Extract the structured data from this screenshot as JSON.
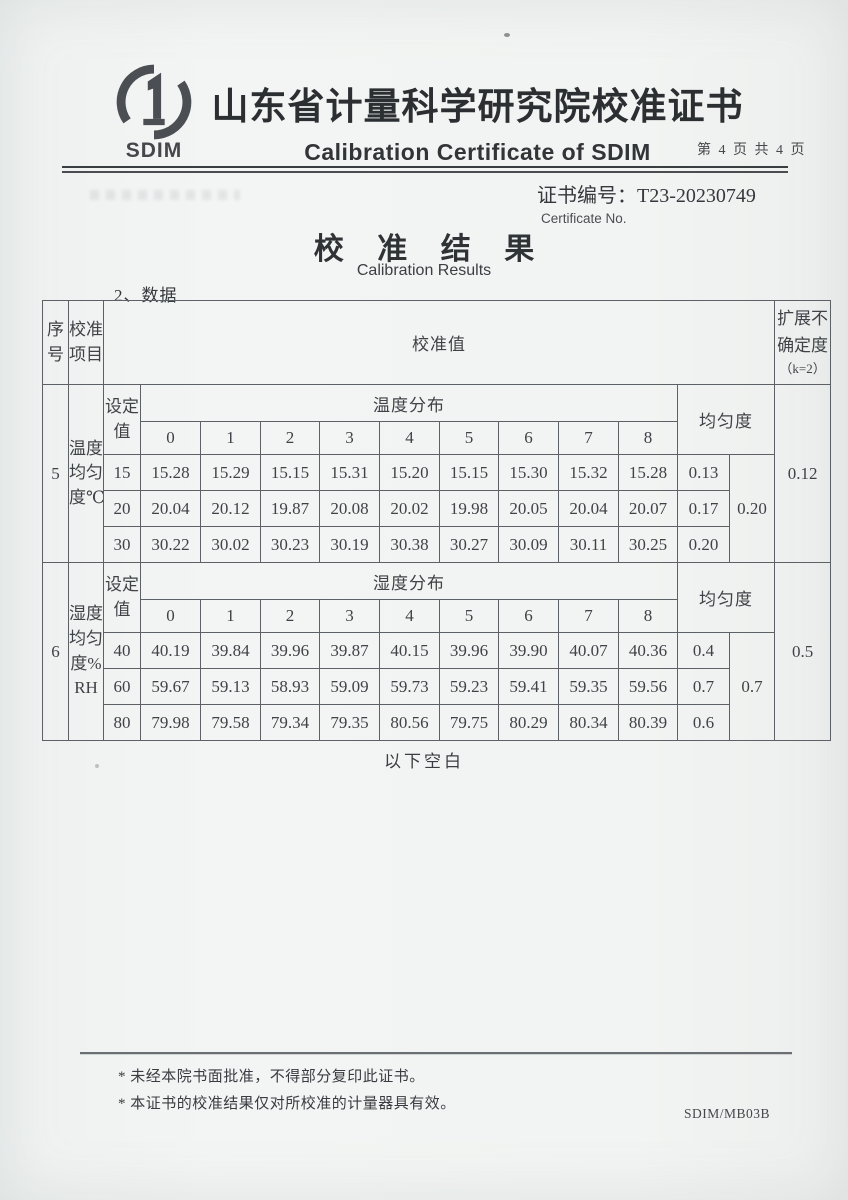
{
  "header": {
    "logo_text": "SDIM",
    "title_cn": "山东省计量科学研究院校准证书",
    "title_en": "Calibration Certificate of SDIM",
    "page_info": "第 4 页 共 4 页"
  },
  "certificate": {
    "no_label": "证书编号：",
    "no_value": "T23-20230749",
    "no_caption": "Certificate No."
  },
  "section": {
    "title_cn": "校 准 结 果",
    "title_en": "Calibration Results",
    "subsection": "2、数据"
  },
  "table": {
    "col_seq": "序号",
    "col_item": "校准项目",
    "col_value": "校准值",
    "col_uncertainty": "扩展不确定度",
    "col_uncertainty_k": "（k=2）",
    "col_setpoint": "设定值",
    "col_uniformity": "均匀度",
    "indices": [
      "0",
      "1",
      "2",
      "3",
      "4",
      "5",
      "6",
      "7",
      "8"
    ],
    "blocks": [
      {
        "seq": "5",
        "item": "温度均匀度℃",
        "distribution": "温度分布",
        "rows": [
          {
            "set": "15",
            "values": [
              "15.28",
              "15.29",
              "15.15",
              "15.31",
              "15.20",
              "15.15",
              "15.30",
              "15.32",
              "15.28"
            ],
            "uniformity": "0.13"
          },
          {
            "set": "20",
            "values": [
              "20.04",
              "20.12",
              "19.87",
              "20.08",
              "20.02",
              "19.98",
              "20.05",
              "20.04",
              "20.07"
            ],
            "uniformity": "0.17"
          },
          {
            "set": "30",
            "values": [
              "30.22",
              "30.02",
              "30.23",
              "30.19",
              "30.38",
              "30.27",
              "30.09",
              "30.11",
              "30.25"
            ],
            "uniformity": "0.20"
          }
        ],
        "overall_uniformity": "0.20",
        "expanded_uncertainty": "0.12"
      },
      {
        "seq": "6",
        "item": "湿度均匀度%RH",
        "distribution": "湿度分布",
        "rows": [
          {
            "set": "40",
            "values": [
              "40.19",
              "39.84",
              "39.96",
              "39.87",
              "40.15",
              "39.96",
              "39.90",
              "40.07",
              "40.36"
            ],
            "uniformity": "0.4"
          },
          {
            "set": "60",
            "values": [
              "59.67",
              "59.13",
              "58.93",
              "59.09",
              "59.73",
              "59.23",
              "59.41",
              "59.35",
              "59.56"
            ],
            "uniformity": "0.7"
          },
          {
            "set": "80",
            "values": [
              "79.98",
              "79.58",
              "79.34",
              "79.35",
              "80.56",
              "79.75",
              "80.29",
              "80.34",
              "80.39"
            ],
            "uniformity": "0.6"
          }
        ],
        "overall_uniformity": "0.7",
        "expanded_uncertainty": "0.5"
      }
    ]
  },
  "below_blank": "以下空白",
  "footer": {
    "note1": "* 未经本院书面批准，不得部分复印此证书。",
    "note2": "* 本证书的校准结果仅对所校准的计量器具有效。",
    "form_no": "SDIM/MB03B"
  },
  "colors": {
    "paper": "#f2f4f3",
    "ink": "#3e4246",
    "table_line": "#5c6166"
  }
}
